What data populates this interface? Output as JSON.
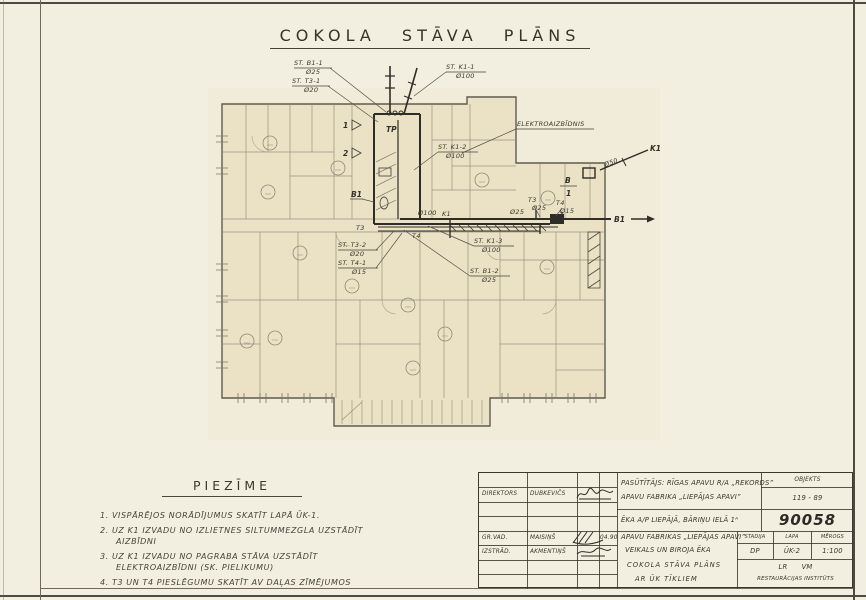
{
  "sheet": {
    "title": "COKOLA STĀVA PLĀNS"
  },
  "plan": {
    "stacks": [
      {
        "name": "ST. B1-1",
        "size": "Ø25"
      },
      {
        "name": "ST. T3-1",
        "size": "Ø20"
      },
      {
        "name": "ST. K1-1",
        "size": "Ø100"
      },
      {
        "name": "ST. K1-2",
        "size": "Ø100"
      },
      {
        "name": "ST. K1-3",
        "size": "Ø100"
      },
      {
        "name": "ST. B1-2",
        "size": "Ø25"
      },
      {
        "name": "ST. T3-2",
        "size": "Ø20"
      },
      {
        "name": "ST. T4-1",
        "size": "Ø15"
      }
    ],
    "labels": {
      "elektro": "ELEKTROAIZBĪDNIS",
      "tp": "TP",
      "b1": "B1",
      "k1": "K1",
      "t3": "T3",
      "t4": "T4",
      "b": "B",
      "one": "1",
      "two": "2"
    },
    "sizes": {
      "d15": "Ø15",
      "d20": "Ø20",
      "d25": "Ø25",
      "d50": "Ø50",
      "d100": "Ø100"
    }
  },
  "notes": {
    "heading": "PIEZĪME",
    "lines": [
      "1. VISPĀRĒJOS NORĀDĪJUMUS SKATĪT LAPĀ ŪK-1.",
      "2. UZ K1 IZVADU NO IZLIETNES SILTUMMEZGLA UZSTĀDĪT",
      "AIZBĪDNI",
      "3. UZ K1 IZVADU NO PAGRABA STĀVA UZSTĀDĪT",
      "ELEKTROAIZBĪDNI (SK. PIELIKUMU)",
      "4. T3 UN T4 PIESLĒGUMU SKATĪT AV DAĻAS ZĪMĒJUMOS"
    ]
  },
  "stamp": {
    "people": [
      {
        "role": "DIREKTORS",
        "name": "DUBKEVIČS",
        "date": ""
      },
      {
        "role": "GR.VAD.",
        "name": "MAISIŅŠ",
        "date": "04.90"
      },
      {
        "role": "IZSTRĀD.",
        "name": "AKMENTIŅŠ",
        "date": ""
      }
    ],
    "client_line1": "PASŪTĪTĀJS: RĪGAS APAVU R/A „REKORDS”",
    "client_line2": "APAVU FABRIKA „LIEPĀJAS APAVI”",
    "object_label": "OBJEKTS",
    "object_no": "119 - 89",
    "building": "ĒKA A/P LIEPĀJĀ, BĀRIŅU IELĀ 1ᴬ",
    "code": "90058",
    "title_line1": "APAVU FABRIKAS „LIEPĀJAS APAVI”",
    "title_line2": "VEIKALS UN BIROJA ĒKA",
    "title_line3": "COKOLA STĀVA PLĀNS",
    "title_line4": "AR ŪK TĪKLIEM",
    "col_stadija": "STADIJA",
    "col_lapa": "LAPA",
    "col_merogs": "MĒROGS",
    "val_stadija": "DP",
    "val_lapa": "ŪK-2",
    "val_merogs": "1:100",
    "org_line1": "LR      VM",
    "org_line2": "RESTAURĀCIJAS INSTITŪTS"
  }
}
